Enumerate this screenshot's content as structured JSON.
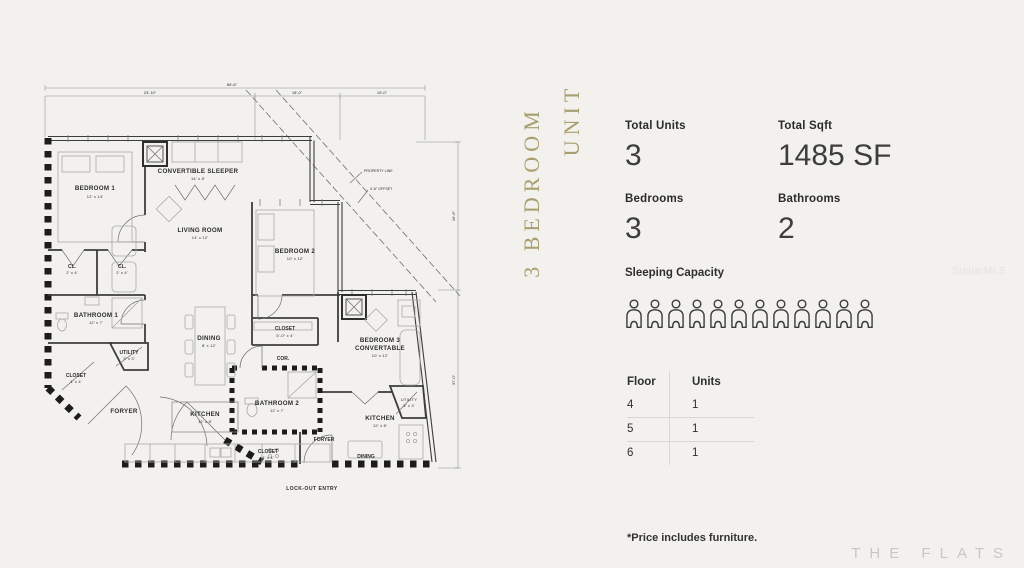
{
  "banner": {
    "line1": "3 BEDROOM",
    "line2": "UNIT",
    "color": "#a89e6e"
  },
  "stats": {
    "total_units": {
      "label": "Total Units",
      "value": "3"
    },
    "total_sqft": {
      "label": "Total Sqft",
      "value": "1485 SF"
    },
    "bedrooms": {
      "label": "Bedrooms",
      "value": "3"
    },
    "bathrooms": {
      "label": "Bathrooms",
      "value": "2"
    }
  },
  "sleeping": {
    "label": "Sleeping Capacity",
    "count": 12,
    "icon": "person-outline-icon"
  },
  "availability_table": {
    "headers": [
      "Floor",
      "Units"
    ],
    "rows": [
      [
        "4",
        "1"
      ],
      [
        "5",
        "1"
      ],
      [
        "6",
        "1"
      ]
    ]
  },
  "footnote": "*Price includes furniture.",
  "brand": "THE FLATS",
  "watermark": "StellarMLS",
  "colors": {
    "accent_gold": "#a89e6e",
    "text_dark": "#2f2f2f",
    "brand_gray": "#c8c7c3",
    "background": "#f2f1ee"
  },
  "floorplan": {
    "rooms": {
      "bedroom1": {
        "name": "BEDROOM 1",
        "dims": "12' x 14'"
      },
      "convertible_sleeper": {
        "name": "CONVERTIBLE SLEEPER",
        "dims": "14' x 8'"
      },
      "living_room": {
        "name": "LIVING ROOM",
        "dims": "14' x 12'"
      },
      "bedroom2": {
        "name": "BEDROOM 2",
        "dims": "10' x 12'"
      },
      "closet_a": {
        "name": "CL.",
        "dims": "2' x 4'"
      },
      "closet_b": {
        "name": "CL.",
        "dims": "2' x 4'"
      },
      "bathroom1": {
        "name": "BATHROOM 1",
        "dims": "12' x 7'"
      },
      "utility1": {
        "name": "UTILITY",
        "dims": "3' x 3'"
      },
      "closet1": {
        "name": "CLOSET",
        "dims": "4' x 4'"
      },
      "foyer1": {
        "name": "FORYER"
      },
      "dining1": {
        "name": "DINING",
        "dims": "8' x 12'"
      },
      "kitchen1": {
        "name": "KITCHEN",
        "dims": "12' x 8'"
      },
      "closet2": {
        "name": "CLOSET",
        "dims": "5'-0\" x 4'"
      },
      "corridor": {
        "name": "COR."
      },
      "bedroom3": {
        "name_line1": "BEDROOM 3",
        "name_line2": "CONVERTABLE",
        "dims": "10' x 12'"
      },
      "bathroom2": {
        "name": "BATHROOM 2",
        "dims": "12' x 7'"
      },
      "foyer2": {
        "name": "FORYER"
      },
      "closet3": {
        "name": "CLOSET",
        "dims": "4' x 4'"
      },
      "kitchen2": {
        "name": "KITCHEN",
        "dims": "12' x 8'"
      },
      "utility2": {
        "name": "UTILITY",
        "dims": "3' x 3'"
      },
      "dining2": {
        "name": "DINING"
      },
      "lockout": {
        "name": "LOCK-OUT ENTRY"
      }
    },
    "dimensions": {
      "top_total": "66'-6\"",
      "top_seg1": "23'-10\"",
      "top_seg2": "18'-0\"",
      "top_seg3": "19'-0\"",
      "right_seg1": "16'-6\"",
      "right_seg2": "37'-0\""
    },
    "annotations": {
      "property_line": "PROPERTY LINE",
      "offset": "4'-6\" OFFSET"
    }
  }
}
